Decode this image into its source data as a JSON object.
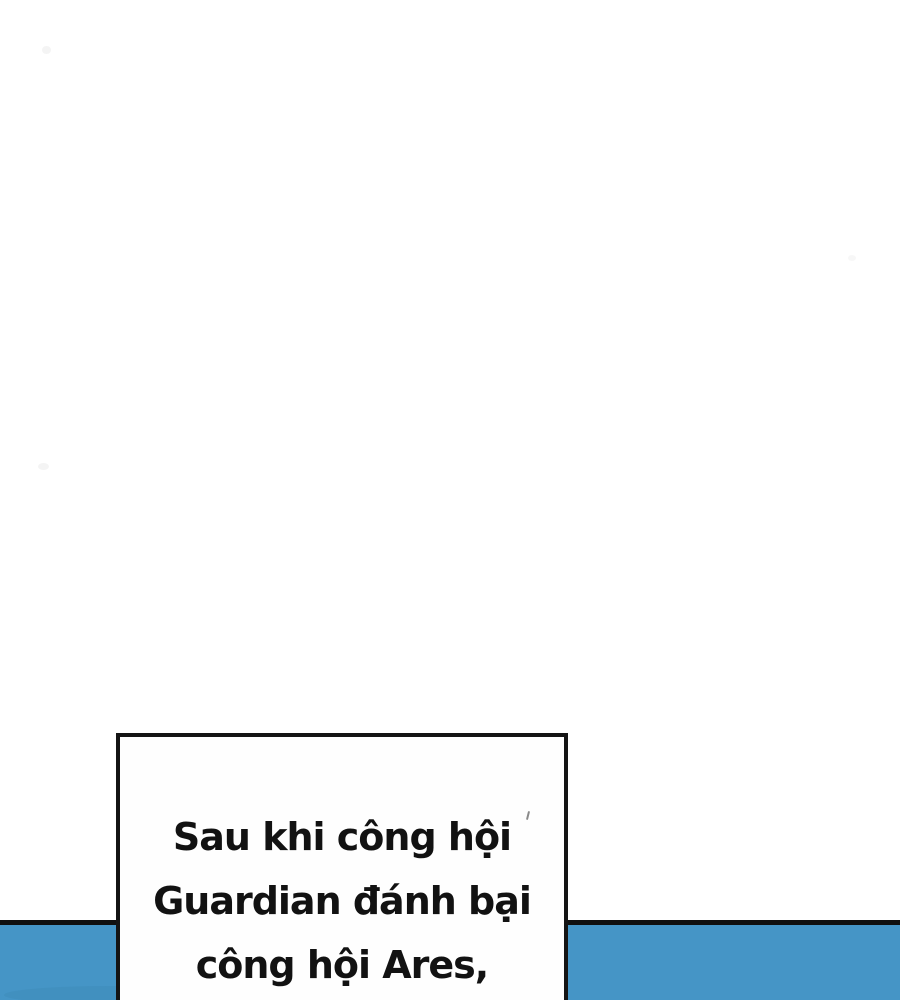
{
  "panel": {
    "background_color": "#ffffff"
  },
  "bubble": {
    "lines": [
      "Sau khi công hội",
      "Guardian đánh bại",
      "công hội Ares,"
    ],
    "fill_color": "#fefefe",
    "border_color": "#141414",
    "text_color": "#121212"
  },
  "band": {
    "color": "#4595c6",
    "top_rule_color": "#101010"
  }
}
